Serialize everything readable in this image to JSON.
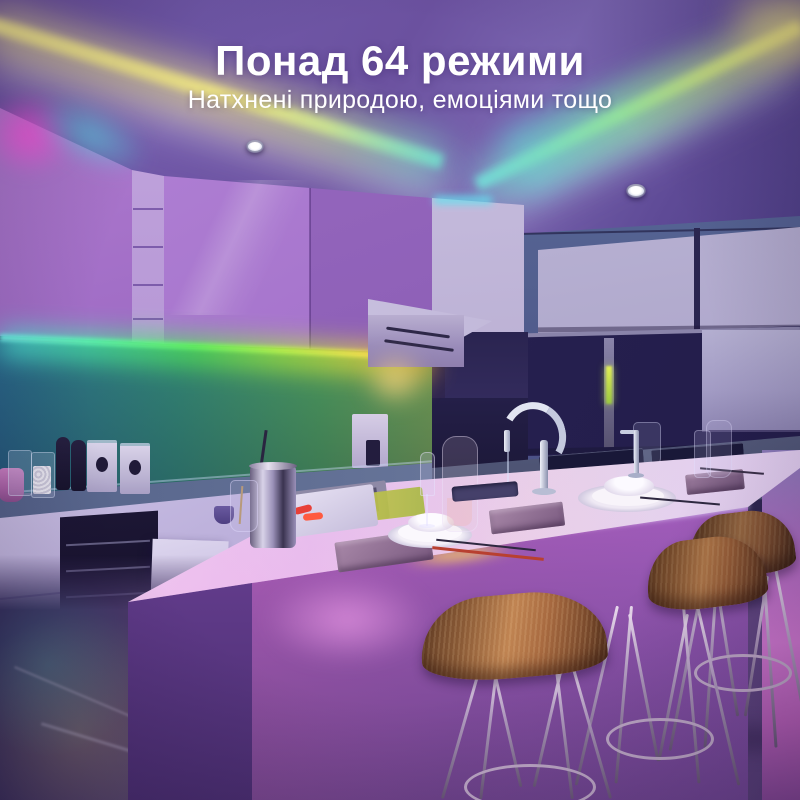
{
  "overlay": {
    "headline": "Понад 64 режими",
    "subtitle": "Натхнені природою, емоціями тощо"
  },
  "palette": {
    "text": "#ffffff",
    "led_yellow": "#eadf82",
    "led_teal": "#5fd8d0",
    "led_green": "#52e852",
    "led_cyan": "#4fd8e8",
    "led_orange": "#f0a83c",
    "led_magenta": "#f05fd8",
    "ceiling_purple": "#6b519f",
    "cabinet_violet": "#9a66c4",
    "window_navy": "#262050",
    "island_pink": "#e07fd8",
    "stool_wood": "#9a6238",
    "floor_purple": "#43336a"
  }
}
